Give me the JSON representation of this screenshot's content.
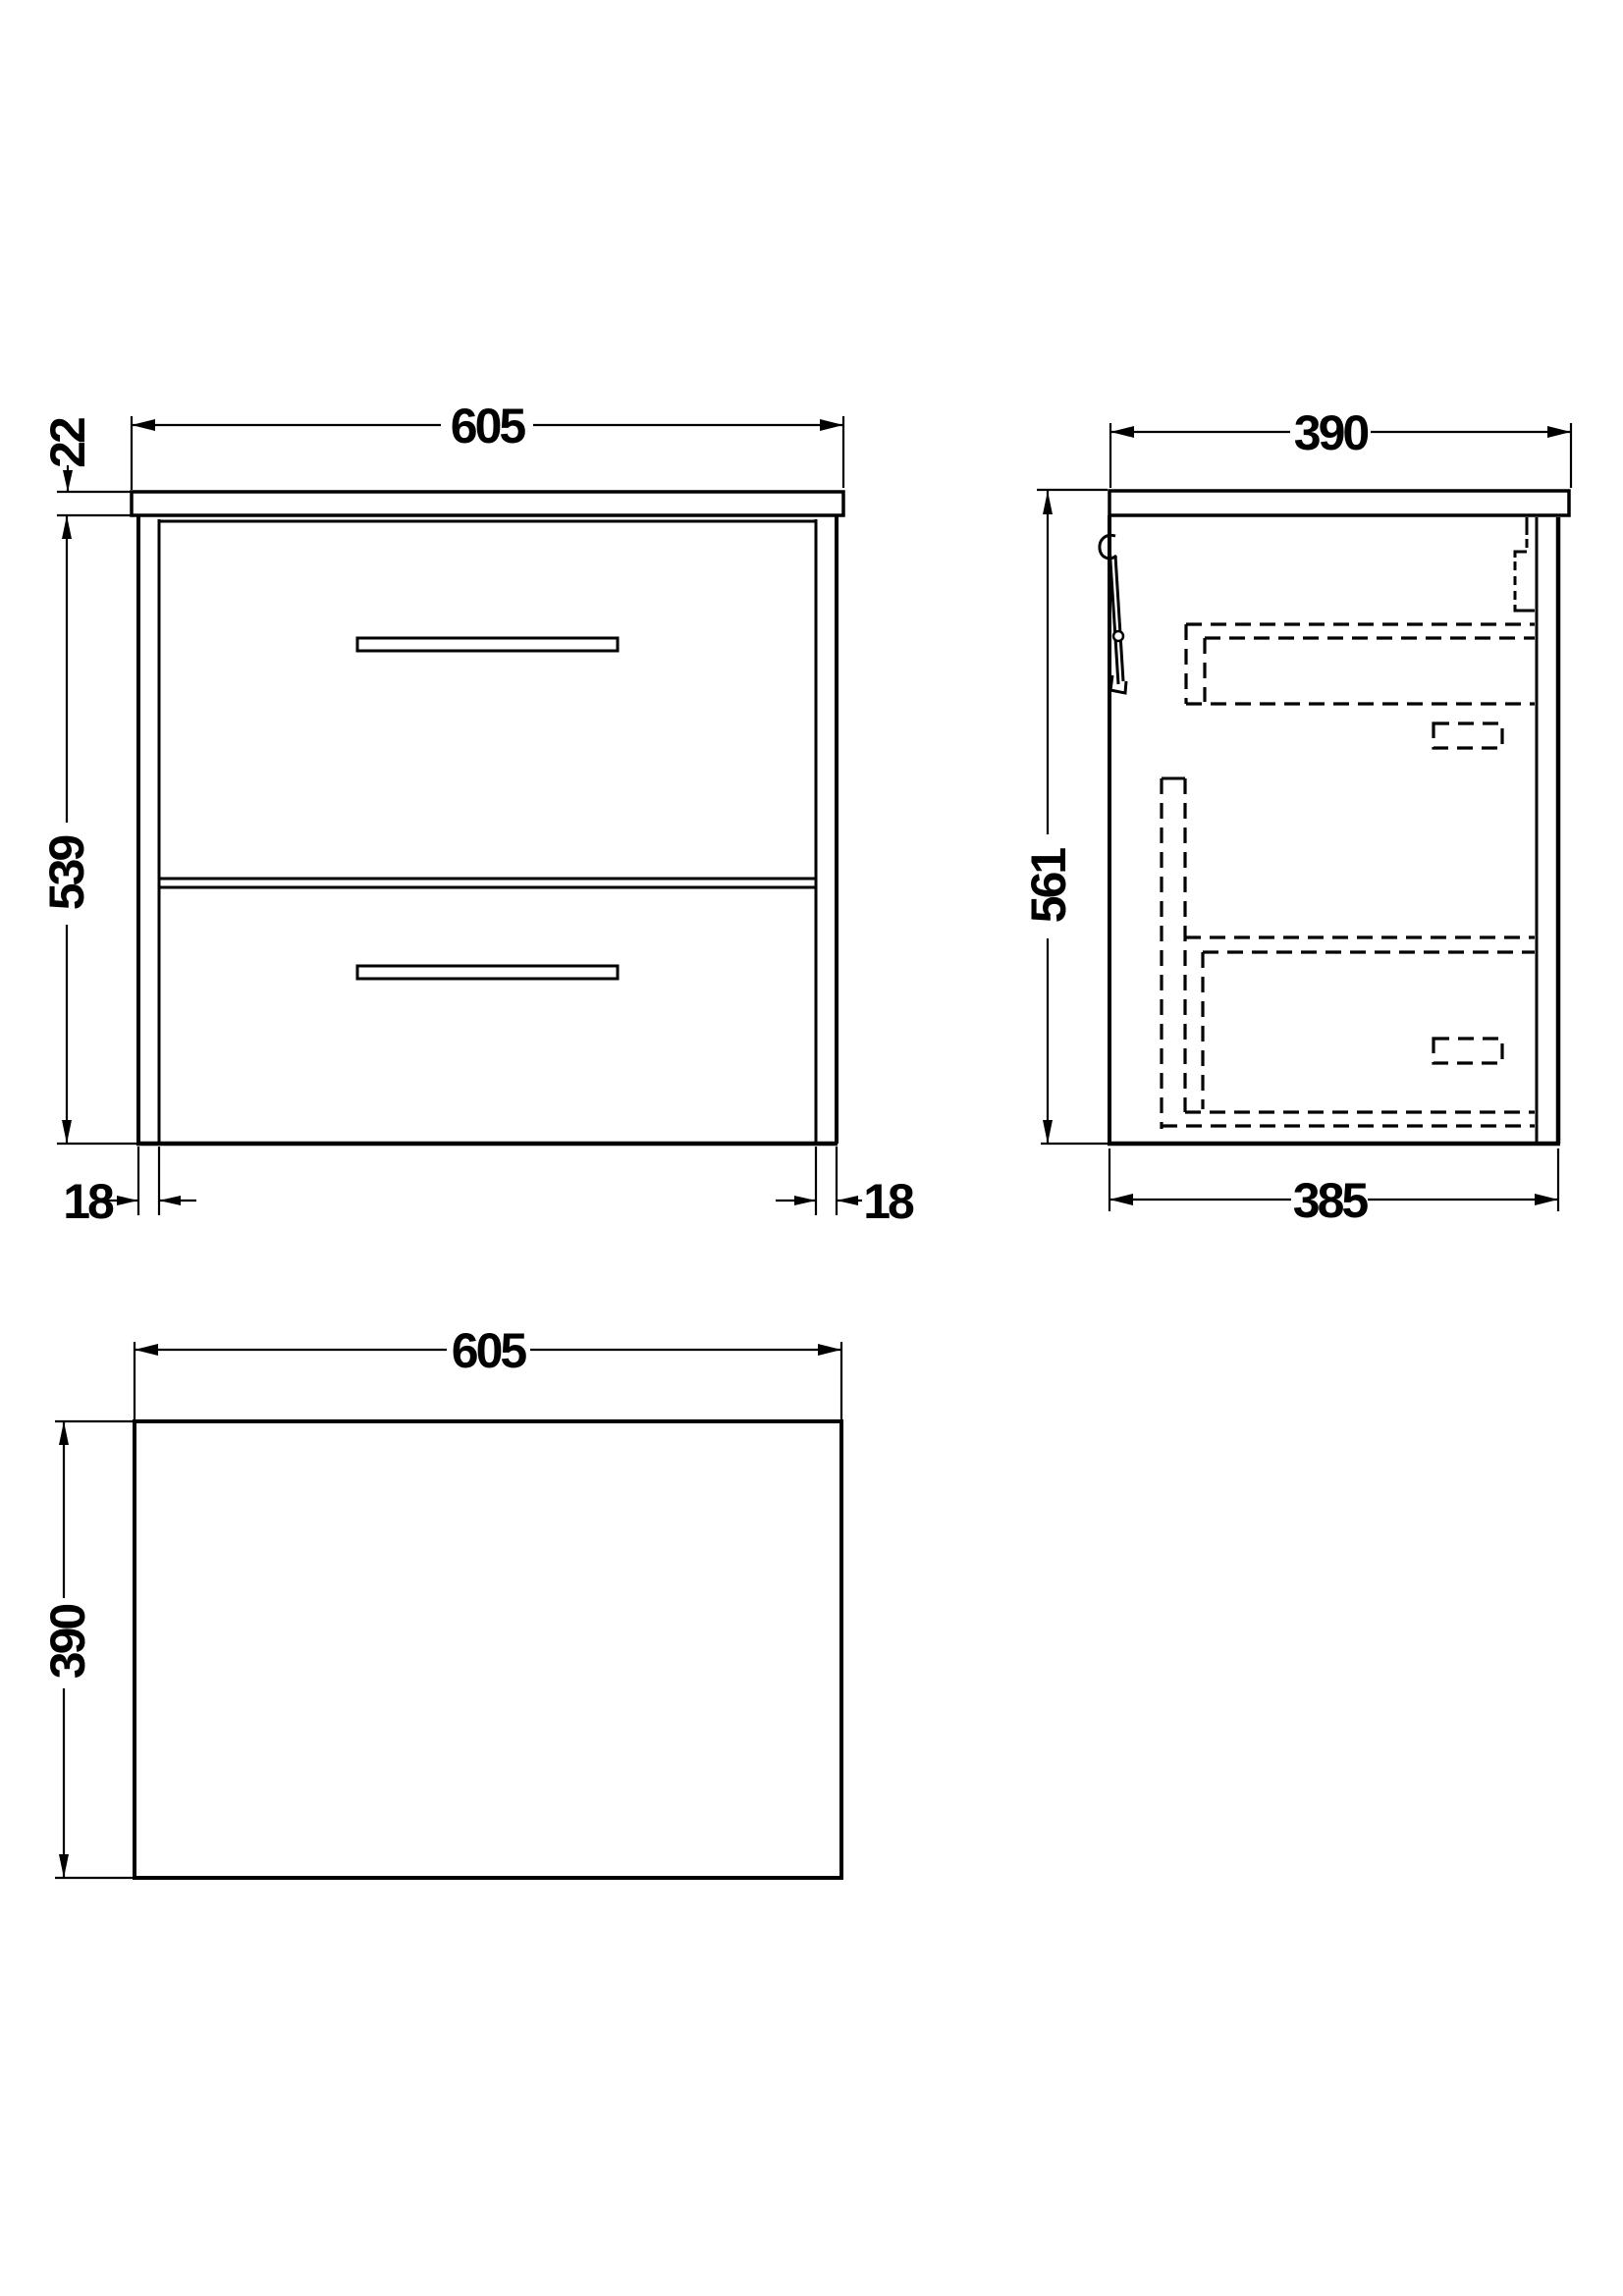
{
  "colors": {
    "line": "#000000",
    "background": "#ffffff"
  },
  "views": {
    "front": {
      "width": "605",
      "worktop_thickness": "22",
      "height": "539",
      "left_panel": "18",
      "right_panel": "18"
    },
    "side": {
      "depth": "390",
      "height": "561",
      "carcass_depth": "385"
    },
    "plan": {
      "width": "605",
      "depth": "390"
    }
  }
}
